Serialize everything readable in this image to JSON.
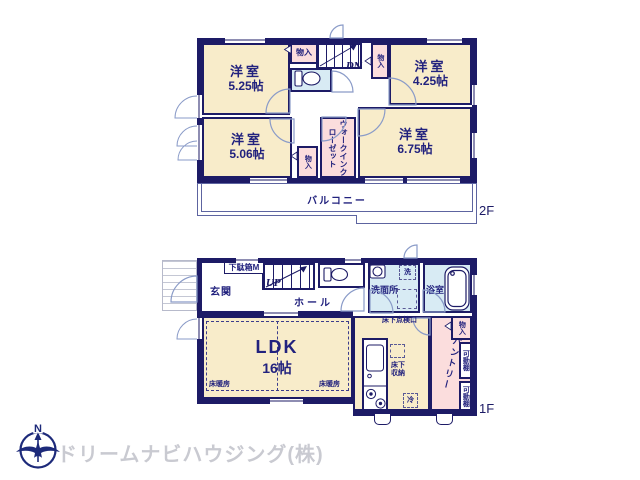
{
  "colors": {
    "wall_navy": "#1d1b66",
    "text_navy": "#22227e",
    "room_cream": "#f8ecca",
    "closet_pink": "#fbdddd",
    "wet_area_blue": "#d8ebf4",
    "balcony_line": "#5d64a0",
    "door_arc": "#8a9bc8",
    "logo_gray": "#c9cad1"
  },
  "floor2": {
    "floor_label": "2F",
    "room_tl": {
      "name": "洋室",
      "size": "5.25帖"
    },
    "room_tr": {
      "name": "洋室",
      "size": "4.25帖"
    },
    "room_bl": {
      "name": "洋室",
      "size": "5.06帖"
    },
    "room_br": {
      "name": "洋室",
      "size": "6.75帖"
    },
    "closet_label": "物入",
    "wic": "ウォークインクローゼット",
    "stairs_down": "DN",
    "balcony": "バルコニー"
  },
  "floor1": {
    "floor_label": "1F",
    "entrance": "玄関",
    "shoe_box": "下駄箱M",
    "stairs_up": "UP",
    "hall": "ホール",
    "washer": "洗",
    "washroom": "洗面所",
    "bathroom": "浴室",
    "underfloor_access": "床下点検口",
    "ldk": {
      "name": "LDK",
      "size": "16帖"
    },
    "floor_heating": "床暖房",
    "underfloor_storage": "床下収納",
    "fridge": "冷",
    "pantry": "パントリー",
    "closet": "物入",
    "shelf_label": "可動棚"
  },
  "footer": {
    "compass_north": "N",
    "company": "ドリームナビハウジング(株)"
  }
}
